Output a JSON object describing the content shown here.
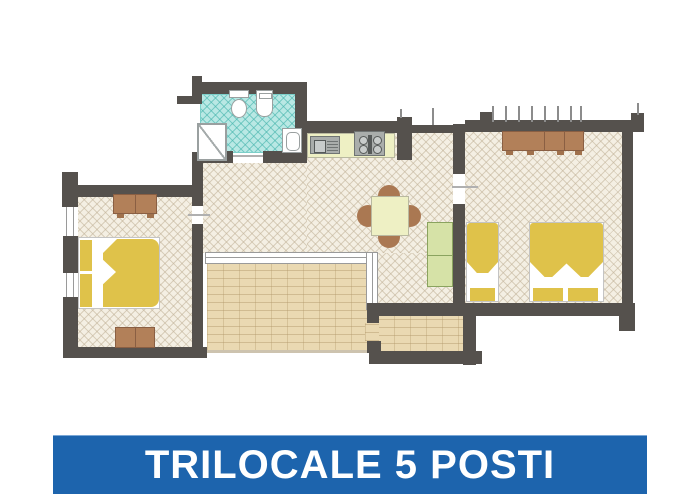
{
  "banner": {
    "label": "TRILOCALE 5 POSTI",
    "background_color": "#1d64ad",
    "text_color": "#ffffff"
  },
  "floor_plan": {
    "type": "apartment-floor-plan",
    "colors": {
      "wall": "#55514d",
      "tile_floor": "#f4efe3",
      "tile_line": "#d9cfbc",
      "bathroom_floor": "#b9e8e4",
      "bathroom_line": "#7ccfc9",
      "terrace_floor": "#ead9b2",
      "kitchen_counter": "#eef0c4",
      "bed_yellow": "#dfc24a",
      "furniture_brown": "#b28059",
      "wardrobe_green": "#d6e2a7",
      "appliance_gray": "#a9adab"
    },
    "rooms": [
      {
        "name": "bathroom",
        "features": [
          "shower",
          "toilet",
          "bidet",
          "washbasin"
        ]
      },
      {
        "name": "kitchen-living-room",
        "features": [
          "kitchen-counter",
          "kitchen-sink",
          "stove",
          "dining-table",
          "four-chairs",
          "green-wardrobe"
        ]
      },
      {
        "name": "bedroom-left",
        "features": [
          "double-bed",
          "dresser",
          "dresser"
        ]
      },
      {
        "name": "bedroom-right",
        "features": [
          "wardrobe",
          "single-bed",
          "double-bed"
        ]
      },
      {
        "name": "terrace-main",
        "features": [
          "sliding-glass-door"
        ]
      },
      {
        "name": "terrace-side",
        "features": []
      }
    ]
  }
}
